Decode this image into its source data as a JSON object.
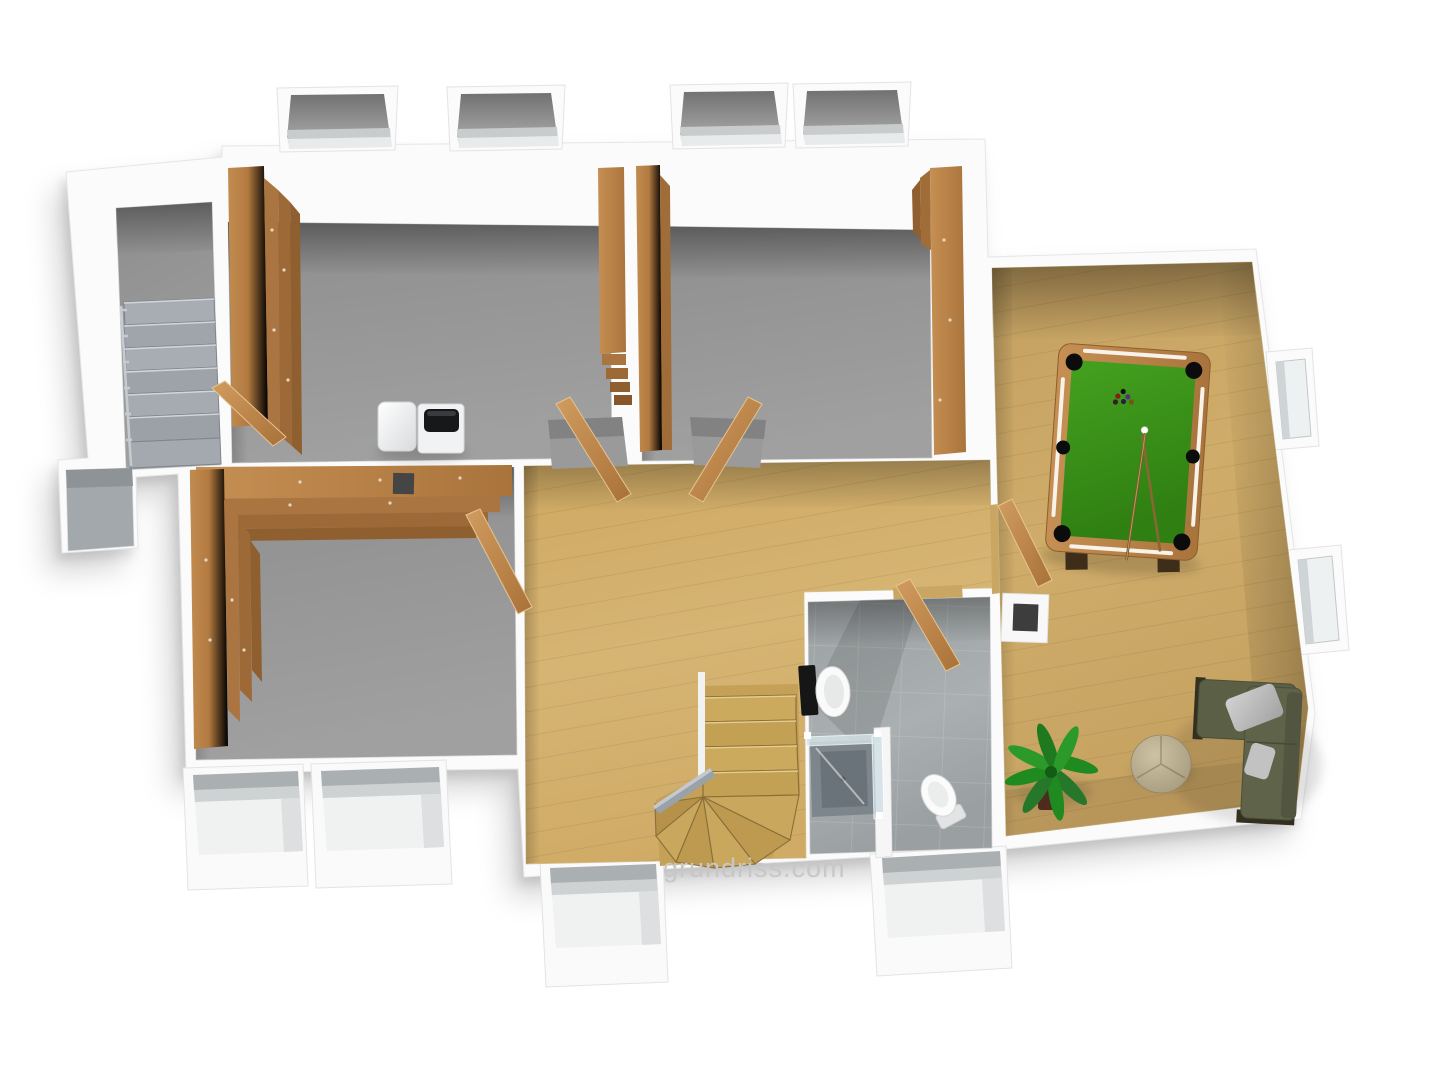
{
  "watermark": {
    "text": "grundriss.com",
    "color": "#c7c7c7"
  },
  "scene": {
    "kind": "3d-floor-plan-render",
    "view": "top-down isometric",
    "background": "#ffffff"
  },
  "palette": {
    "wall_white": "#fbfbfb",
    "wall_edge": "#e2e2e2",
    "concrete_floor": "#959595",
    "oak_floor": "#d2ae6c",
    "game_oak_floor": "#cdaa67",
    "shelf_wood": "#b5busy7f45",
    "door_wood": "#c2925a",
    "stair_wood": "#c7a558",
    "pool_felt_green": "#3d9a1d",
    "sofa_olive": "#5c6047",
    "pillow_gray": "#c4c4c4",
    "plant_green": "#238223",
    "metal_gray": "#9aa2a8",
    "tile_gray": "#a6abac"
  },
  "rooms": [
    {
      "name": "exterior-basement-stairs",
      "floor": "concrete",
      "features": [
        "straight staircase",
        "handrail",
        "lower landing"
      ]
    },
    {
      "name": "cellar-room-left",
      "floor": "concrete",
      "features": [
        "wall shelving",
        "washing machine",
        "white appliance",
        "door to stair well"
      ]
    },
    {
      "name": "cellar-room-middle",
      "floor": "concrete",
      "features": [
        "wall shelving both sides",
        "two window light wells"
      ]
    },
    {
      "name": "storage-room-lower-left",
      "floor": "concrete",
      "features": [
        "L-shaped tiered shelving",
        "wall niche",
        "two window light wells"
      ]
    },
    {
      "name": "hallway",
      "floor": "oak",
      "features": [
        "winder staircase",
        "handrail",
        "doors to all rooms",
        "window light well"
      ]
    },
    {
      "name": "bathroom",
      "floor": "gray-tile",
      "features": [
        "toilet",
        "second toilet",
        "glass shower",
        "partition wall",
        "window light well"
      ]
    },
    {
      "name": "hobby-room",
      "floor": "oak",
      "features": [
        "pool table",
        "corner sofa",
        "round pouf",
        "palm plant",
        "wall niche",
        "two windows"
      ]
    }
  ],
  "furniture": [
    "pool-table-with-balls-and-two-cues",
    "corner-sofa-olive-with-two-gray-pillows",
    "round-beige-pouf",
    "palm-plant",
    "washing-machine",
    "white-appliance",
    "wooden-shelving-units",
    "toilet-black-cistern",
    "toilet-white",
    "glass-shower-enclosure"
  ],
  "windows": {
    "top_wall": 4,
    "right_wall": 2,
    "bottom_wall": 4
  }
}
